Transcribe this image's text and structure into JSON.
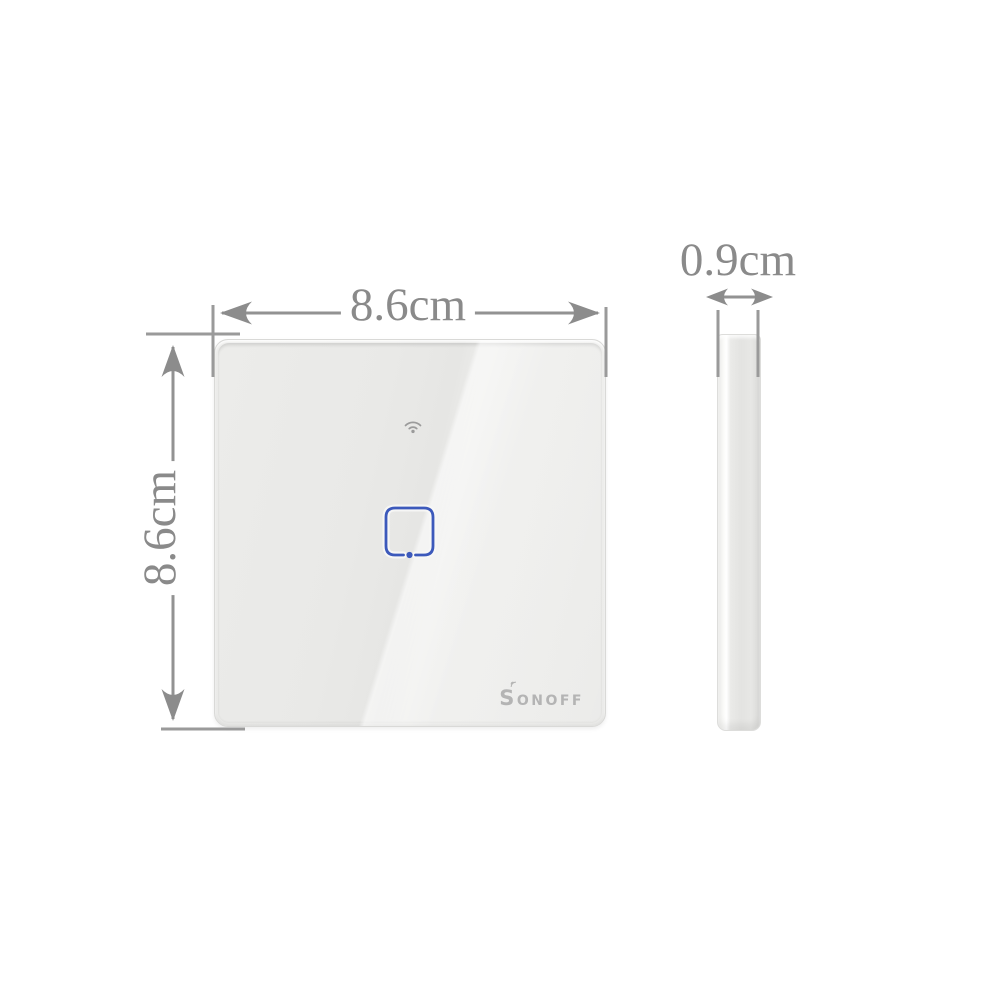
{
  "dimensions": {
    "width": "8.6cm",
    "height": "8.6cm",
    "depth": "0.9cm"
  },
  "device": {
    "brand": "SONOFF"
  },
  "icons": {
    "wifi": "wifi-icon",
    "touch_button": "touch-button-icon",
    "signal_mark": "signal-icon"
  },
  "colors": {
    "background": "#ffffff",
    "dimension_lines": "#929292",
    "label_text": "#8a8a8a",
    "panel_body": "#e9e9e7",
    "accent_blue": "#3c59bb",
    "logo_text": "#b4b4b4",
    "side_view_body": "#e3e3e1"
  }
}
